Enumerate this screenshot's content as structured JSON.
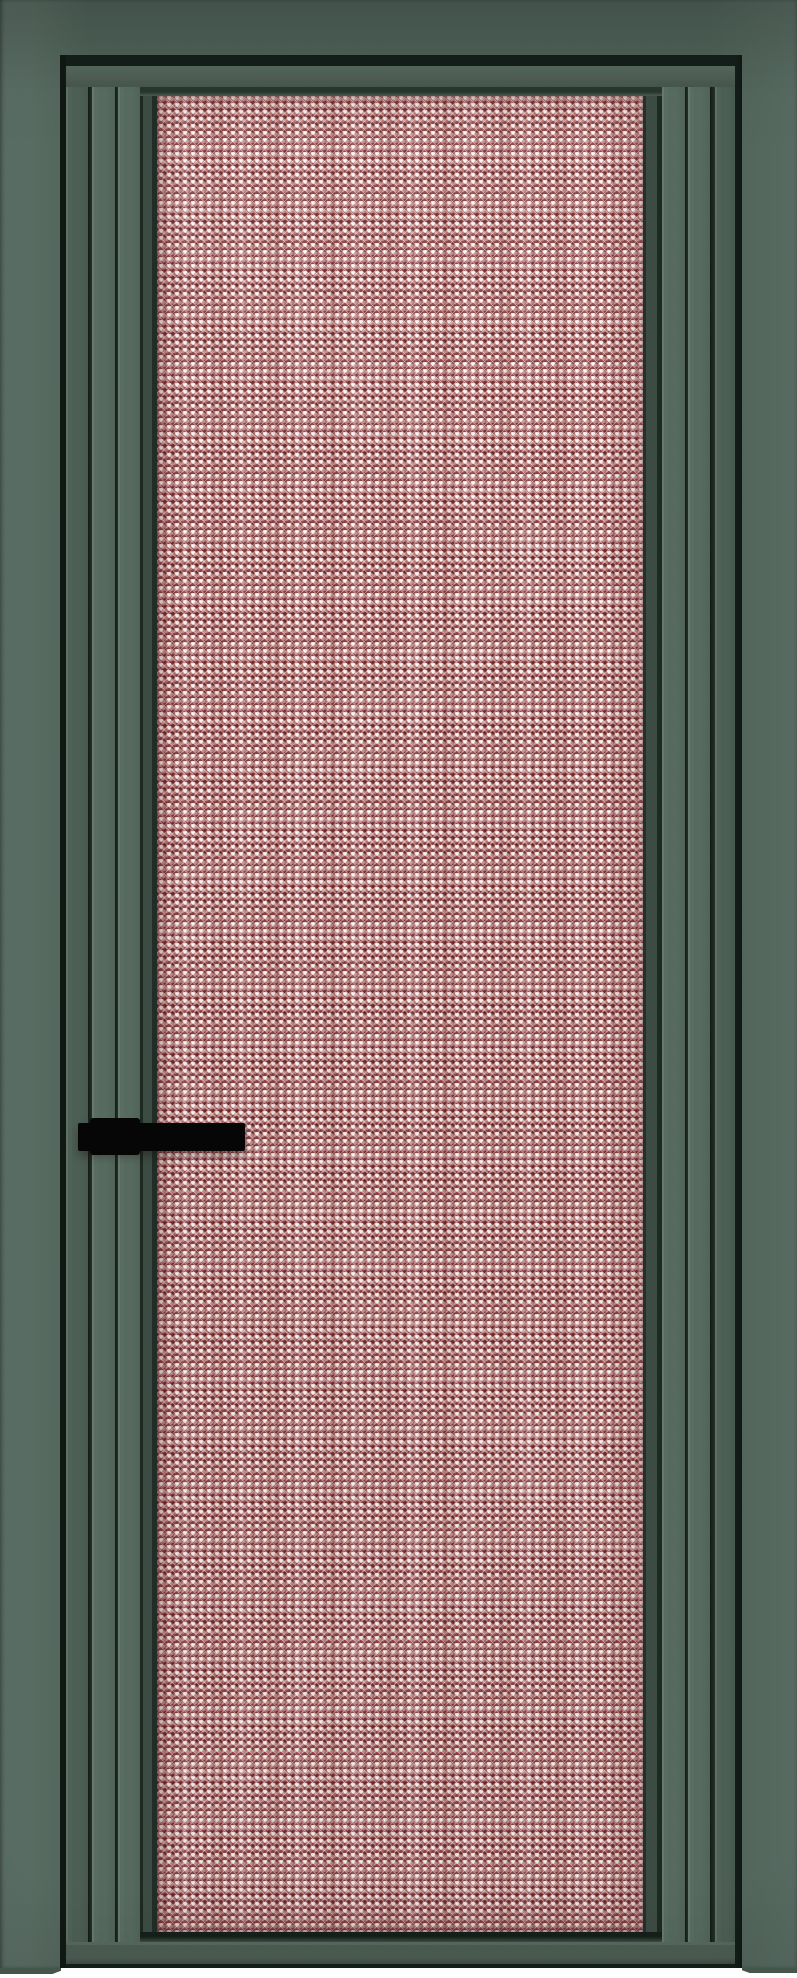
{
  "meta": {
    "description": "Product render of an interior door: dark sage-green aluminium casing and door leaf with fluted (grooved) stiles, a large glazed panel of red-pink prismatic diamond-faceted textured glass, a black lever handle on the left stile, and a thin white floor strip at the bottom. No visible text anywhere in the image.",
    "visible_text": []
  },
  "colors": {
    "casing": "#4f6359",
    "casing_light": "#5b6f64",
    "casing_dark": "#44554c",
    "groove": "#131d18",
    "leaf": "#50645a",
    "band_light": "#566a5f",
    "band_dark": "#4c5f55",
    "rail": "#4b5d53",
    "chamfer": "#3c4c43",
    "chamfer_dark": "#1c2822",
    "glass_base": "#bb7e7e",
    "glass_highlight": "#eedcdc",
    "glass_mid": "#c68c8c",
    "glass_mid2": "#b17070",
    "glass_dark": "#8d4040",
    "glass_deep": "#6e2a2a",
    "handle": "#060606",
    "floor": "#ffffff"
  },
  "glass_pattern": {
    "type": "prismatic-diamond-facet",
    "cell_width_px": 8,
    "cell_height_px": 7,
    "effects": [
      "white sparkle glints",
      "dark red facet dots",
      "vertical moire streaks",
      "edge vignette"
    ]
  },
  "parts": {
    "frame": "door casing frame (top, left, right)",
    "leaf": "door leaf with three fluted bands per stile",
    "glass": "textured glass panel",
    "handle": "black lever handle with rectangular base, left side",
    "floor": "white floor strip under door"
  }
}
